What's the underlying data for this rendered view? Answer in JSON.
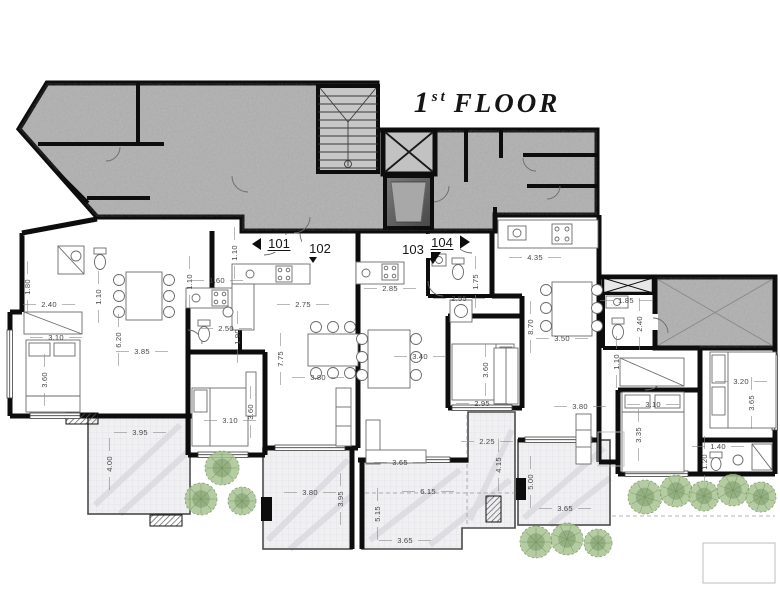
{
  "title": {
    "number": "1",
    "ordinal": "st",
    "rest": "FLOOR"
  },
  "units": [
    {
      "label": "101",
      "x": 279,
      "y": 248,
      "underline": true
    },
    {
      "label": "102",
      "x": 320,
      "y": 253,
      "underline": false
    },
    {
      "label": "103",
      "x": 413,
      "y": 254,
      "underline": false
    },
    {
      "label": "104",
      "x": 442,
      "y": 247,
      "underline": true
    }
  ],
  "dimensions": [
    {
      "t": "1.80",
      "x": 30,
      "y": 287,
      "v": true
    },
    {
      "t": "2.40",
      "x": 49,
      "y": 307,
      "v": false
    },
    {
      "t": "1.10",
      "x": 101,
      "y": 297,
      "v": true
    },
    {
      "t": "3.10",
      "x": 56,
      "y": 340,
      "v": false
    },
    {
      "t": "6.20",
      "x": 121,
      "y": 340,
      "v": true
    },
    {
      "t": "3.85",
      "x": 142,
      "y": 354,
      "v": false
    },
    {
      "t": "3.60",
      "x": 47,
      "y": 380,
      "v": true
    },
    {
      "t": "1.10",
      "x": 192,
      "y": 282,
      "v": true
    },
    {
      "t": "1.60",
      "x": 217,
      "y": 283,
      "v": false
    },
    {
      "t": "1.10",
      "x": 237,
      "y": 253,
      "v": true
    },
    {
      "t": "2.50",
      "x": 226,
      "y": 331,
      "v": false
    },
    {
      "t": "1.90",
      "x": 240,
      "y": 337,
      "v": true
    },
    {
      "t": "2.75",
      "x": 303,
      "y": 307,
      "v": false
    },
    {
      "t": "7.75",
      "x": 283,
      "y": 359,
      "v": true
    },
    {
      "t": "3.80",
      "x": 318,
      "y": 380,
      "v": false
    },
    {
      "t": "3.10",
      "x": 230,
      "y": 423,
      "v": false
    },
    {
      "t": "3.60",
      "x": 253,
      "y": 412,
      "v": true
    },
    {
      "t": "2.85",
      "x": 390,
      "y": 291,
      "v": false
    },
    {
      "t": "2.55",
      "x": 459,
      "y": 301,
      "v": false
    },
    {
      "t": "1.75",
      "x": 478,
      "y": 282,
      "v": true
    },
    {
      "t": "3.40",
      "x": 420,
      "y": 359,
      "v": false
    },
    {
      "t": "3.60",
      "x": 488,
      "y": 370,
      "v": true
    },
    {
      "t": "2.95",
      "x": 482,
      "y": 406,
      "v": false
    },
    {
      "t": "3.65",
      "x": 400,
      "y": 465,
      "v": false
    },
    {
      "t": "4.35",
      "x": 535,
      "y": 260,
      "v": false
    },
    {
      "t": "8.70",
      "x": 533,
      "y": 327,
      "v": true
    },
    {
      "t": "3.50",
      "x": 562,
      "y": 341,
      "v": false
    },
    {
      "t": "1.85",
      "x": 626,
      "y": 303,
      "v": false
    },
    {
      "t": "2.40",
      "x": 642,
      "y": 324,
      "v": true
    },
    {
      "t": "1.10",
      "x": 619,
      "y": 362,
      "v": true
    },
    {
      "t": "3.80",
      "x": 580,
      "y": 409,
      "v": false
    },
    {
      "t": "3.20",
      "x": 741,
      "y": 384,
      "v": false
    },
    {
      "t": "3.65",
      "x": 754,
      "y": 403,
      "v": true
    },
    {
      "t": "3.10",
      "x": 653,
      "y": 407,
      "v": false
    },
    {
      "t": "3.35",
      "x": 641,
      "y": 435,
      "v": true
    },
    {
      "t": "1.40",
      "x": 718,
      "y": 449,
      "v": false
    },
    {
      "t": "1.20",
      "x": 707,
      "y": 462,
      "v": true
    },
    {
      "t": "3.95",
      "x": 140,
      "y": 435,
      "v": false
    },
    {
      "t": "4.00",
      "x": 112,
      "y": 464,
      "v": true
    },
    {
      "t": "3.80",
      "x": 310,
      "y": 495,
      "v": false
    },
    {
      "t": "3.95",
      "x": 343,
      "y": 499,
      "v": true
    },
    {
      "t": "6.15",
      "x": 428,
      "y": 494,
      "v": false
    },
    {
      "t": "5.15",
      "x": 380,
      "y": 514,
      "v": true
    },
    {
      "t": "3.65",
      "x": 405,
      "y": 543,
      "v": false
    },
    {
      "t": "2.25",
      "x": 487,
      "y": 444,
      "v": false
    },
    {
      "t": "4.15",
      "x": 501,
      "y": 465,
      "v": true
    },
    {
      "t": "5.00",
      "x": 533,
      "y": 482,
      "v": true
    },
    {
      "t": "3.65",
      "x": 565,
      "y": 511,
      "v": false
    }
  ],
  "plants": [
    {
      "type": "bush",
      "x": 222,
      "y": 468,
      "r": 17
    },
    {
      "type": "bush",
      "x": 201,
      "y": 499,
      "r": 16
    },
    {
      "type": "bush",
      "x": 242,
      "y": 501,
      "r": 14
    },
    {
      "type": "palm",
      "x": 645,
      "y": 497,
      "r": 17
    },
    {
      "type": "palm",
      "x": 676,
      "y": 491,
      "r": 16
    },
    {
      "type": "palm",
      "x": 704,
      "y": 496,
      "r": 15
    },
    {
      "type": "palm",
      "x": 733,
      "y": 490,
      "r": 16
    },
    {
      "type": "palm",
      "x": 761,
      "y": 497,
      "r": 15
    },
    {
      "type": "bush",
      "x": 536,
      "y": 542,
      "r": 16
    },
    {
      "type": "palm",
      "x": 567,
      "y": 539,
      "r": 16
    },
    {
      "type": "bush",
      "x": 598,
      "y": 543,
      "r": 14
    }
  ],
  "colors": {
    "wall": "#0d0d0d",
    "concrete": "#b7b7b7",
    "marble": "#f0f0f2",
    "plant_dark": "#6f8f5a",
    "plant_light": "#a9c492",
    "dim_text": "#474747",
    "elevator_dark": "#5d5d5d"
  }
}
